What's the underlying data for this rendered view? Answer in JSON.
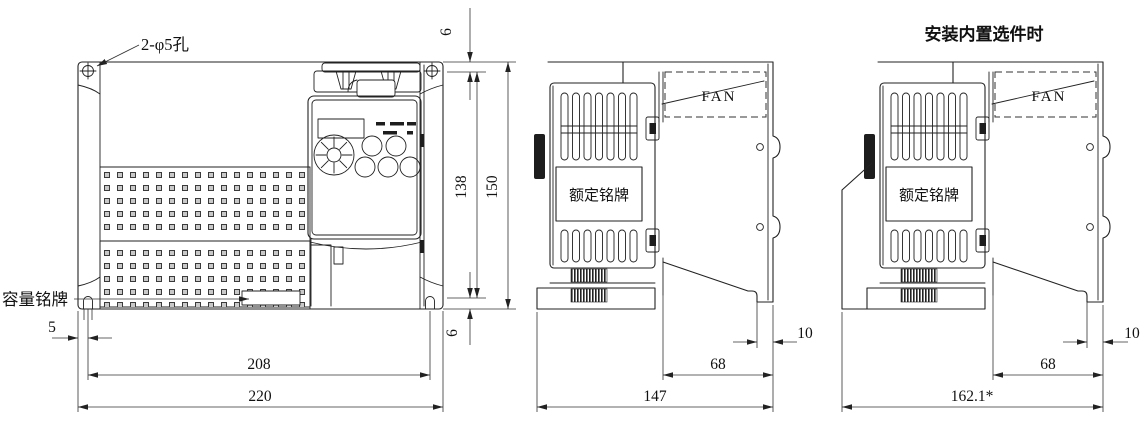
{
  "front_view": {
    "hole_label": "2-φ5孔",
    "capacity_nameplate_label": "容量铭牌",
    "dim_top_hole_offset": "6",
    "dim_hole_pitch_vertical": "138",
    "dim_overall_height": "150",
    "dim_bottom_hole_offset": "6",
    "dim_left_hole_offset": "5",
    "dim_hole_pitch_horizontal": "208",
    "dim_overall_width": "220"
  },
  "side_view": {
    "fan_label": "FAN",
    "rating_nameplate_label": "额定铭牌",
    "dim_heatsink_depth": "68",
    "dim_overall_depth": "147",
    "dim_back_protrusion": "10"
  },
  "option_side_view": {
    "title": "安装内置选件时",
    "fan_label": "FAN",
    "rating_nameplate_label": "额定铭牌",
    "dim_heatsink_depth": "68",
    "dim_overall_depth": "162.1*",
    "dim_back_protrusion": "10"
  }
}
